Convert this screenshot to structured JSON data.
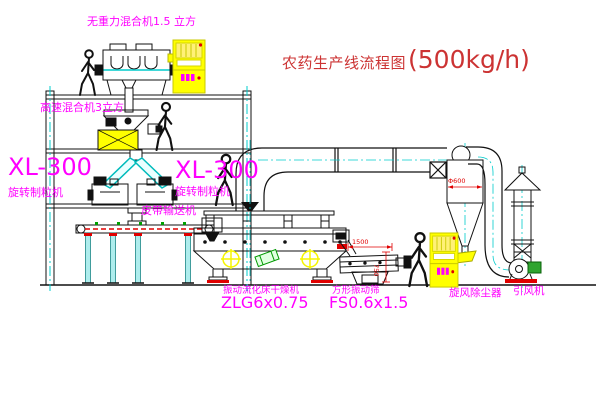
{
  "title": {
    "name": "农药生产线流程图",
    "capacity": "(500kg/h)"
  },
  "labels": {
    "gravity_free_mixer": "无重力混合机1.5 立方",
    "high_speed_mixer": "高速混合机3立方",
    "granulator_left_model": "XL-300",
    "granulator_left_name": "旋转制粒机",
    "granulator_right_model": "XL-300",
    "granulator_right_name": "旋转制粒机",
    "belt_conveyor": "皮带输送机",
    "dryer_name": "振动流化床干燥机",
    "dryer_model": "ZLG6x0.75",
    "sieve_name": "方形振动筛",
    "sieve_model": "FS0.6x1.5",
    "cyclone": "旋风除尘器",
    "fan": "引风机"
  },
  "dims": {
    "cyclone_dia": "Φ600",
    "sieve_len": "1500",
    "sieve_h": "750"
  },
  "colors": {
    "label": "#FF00FF",
    "title": "#CC3333",
    "dimension": "#E00000",
    "centerline": "#00CCCC",
    "cabinet": "#FFFF00"
  }
}
